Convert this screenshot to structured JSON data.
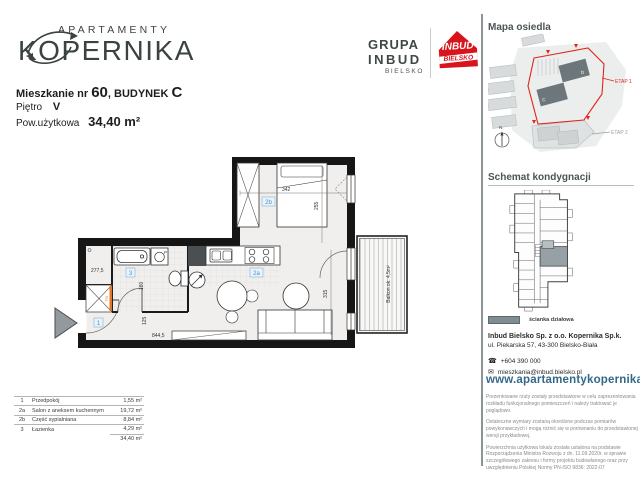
{
  "brand": {
    "logo_top": "APARTAMENTY",
    "logo_main": "KOPERNIKA"
  },
  "header": {
    "unit_label": "Mieszkanie nr",
    "unit_number": "60",
    "building_label": ", BUDYNEK",
    "building_value": "C",
    "floor_label": "Piętro",
    "floor_value": "V",
    "area_label": "Pow.użytkowa",
    "area_value": "34,40 m²"
  },
  "group_logo": {
    "line1": "GRUPA",
    "line2": "INBUD",
    "line3": "BIELSKO"
  },
  "inbud_logo": {
    "top": "INBUD",
    "bottom": "BIELSKO"
  },
  "map": {
    "title": "Mapa osiedla",
    "etap1": "ETAP 1",
    "etap2": "ETAP 2",
    "north": "N",
    "building_c": "C",
    "building_d": "D"
  },
  "schemat": {
    "title": "Schemat kondygnacji"
  },
  "legend": {
    "label": "ścianka działowa"
  },
  "contact": {
    "company": "Inbud Bielsko Sp. z o.o. Kopernika Sp.k.",
    "address": "ul. Piekarska 57, 43-300 Bielsko-Biała",
    "phone": "+604 390 000",
    "email": "mieszkania@inbud.bielsko.pl",
    "website": "www.apartamentykopernika.pl"
  },
  "rooms": {
    "rows": [
      {
        "no": "1",
        "name": "Przedpokój",
        "area": "1,55 m²"
      },
      {
        "no": "2a",
        "name": "Salon z aneksem kuchennym",
        "area": "19,72 m²"
      },
      {
        "no": "2b",
        "name": "Część sypialniana",
        "area": "8,84 m²"
      },
      {
        "no": "3",
        "name": "Łazienka",
        "area": "4,29 m²"
      }
    ],
    "total": "34,40 m²"
  },
  "plan": {
    "labels": {
      "room1": "1",
      "room2a": "2a",
      "room2b": "2b",
      "room3": "3",
      "washer": "P",
      "wardrobe": "TM",
      "balcony": "Balkon ok. 4,5m²"
    },
    "dims": {
      "d277": "277,5",
      "d180": "180",
      "d125": "125",
      "d844": "844,5",
      "d342": "342",
      "d255": "255",
      "d315": "315"
    }
  },
  "disclaimer": {
    "p1": "Prezentowane rzuty zostały przedstawione w celu zaprezentowania rozkładu funkcjonalnego pomieszczeń i należy traktować je poglądowo.",
    "p2": "Ostateczne wymiary zostaną określone podczas pomiarów powykonawczych i mogą różnić się w porównaniu do przedstawionej wersji przykładowej.",
    "p3": "Powierzchnia użytkowa lokalu została ustalona na podstawie Rozporządzenia Ministra Rozwoju z dn. 11.09.2020r. w sprawie szczegółowego zakresu i formy projektu budowlanego oraz przy uwzględnieniu Polskiej Normy PN-ISO 9836: 2022-07"
  },
  "colors": {
    "brand_dark": "#3a433f",
    "logo_red": "#d8151d",
    "room_label_blue": "#4d8fc4",
    "accent_orange": "#e87722",
    "website_blue": "#33688a"
  }
}
